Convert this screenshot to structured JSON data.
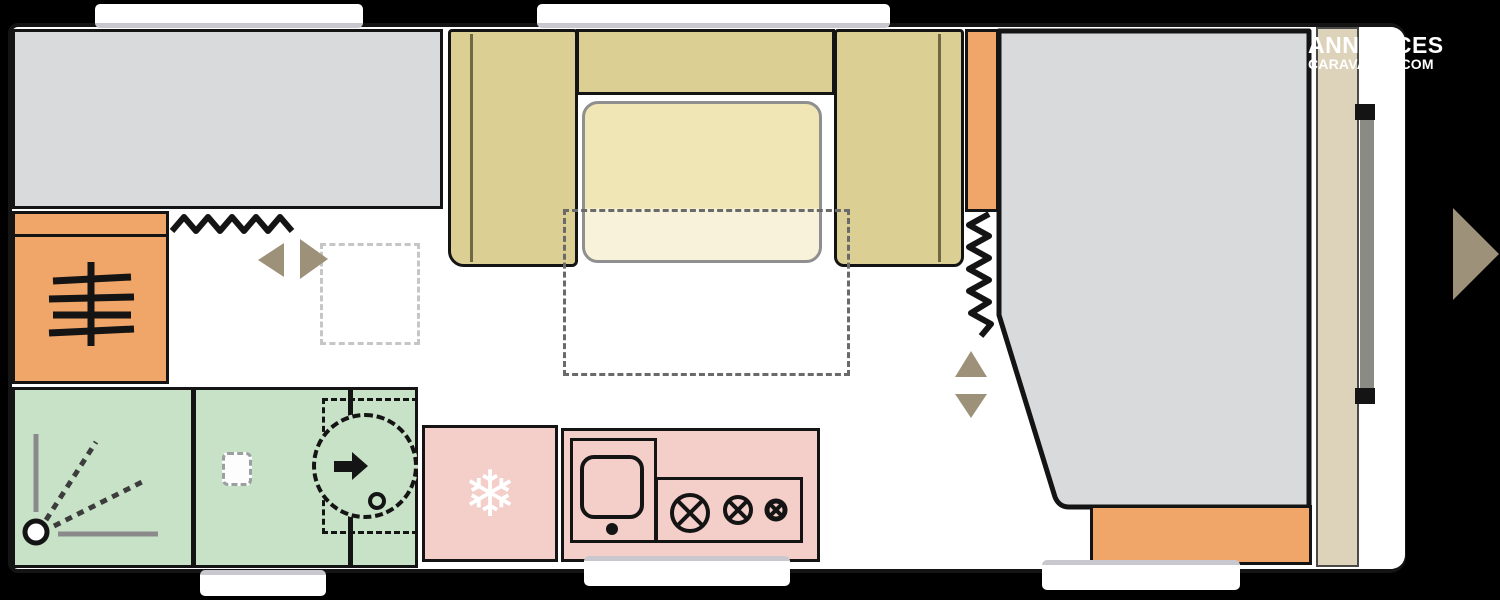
{
  "watermark": {
    "line1": "ANNONCES",
    "line2": "CARAVANES.COM"
  },
  "icons": {
    "fridge_snowflake": "❄",
    "heater": "radiator-lines",
    "shower": "spray-lines-from-drain",
    "toilet": "cassette-square",
    "swivel_basin": "dashed-circle-with-arrow",
    "stove": "three-gas-burners",
    "curtains": "zigzag-lines",
    "slide_arrows": "left-right-triangles",
    "bed_lift_arrows": "up-down-triangles",
    "entry_arrow": "right-triangle"
  },
  "colors": {
    "background": "#000000",
    "wall": "#141414",
    "floor": "#ffffff",
    "bed_gray": "#d9dadc",
    "bench_khaki": "#dbcf93",
    "bench_divider": "#6f6845",
    "table_cream": "#f0e5b4",
    "table_cream_light": "#f8f2da",
    "table_border": "#8f8f8f",
    "cabinet_orange": "#f0a569",
    "washroom_green": "#c8e2c8",
    "kitchen_pink": "#f4cfca",
    "headboard_tan": "#ddd3ba",
    "door_gray": "#8b8b86",
    "arrow_taupe": "#9d9179",
    "window_trim": "#c8c8ce",
    "dash_dark": "#6a6a6a",
    "dash_light": "#c6c6c6"
  }
}
